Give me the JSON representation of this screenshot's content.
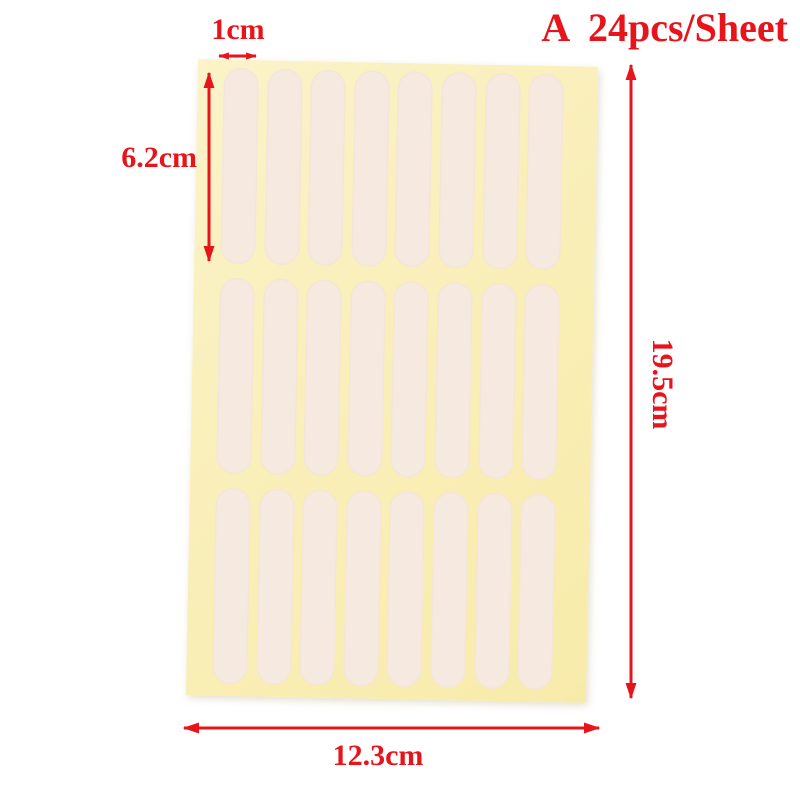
{
  "accent_color": "#e8141b",
  "title": {
    "text": "A  24pcs/Sheet"
  },
  "sheet": {
    "rows": 3,
    "cols": 8,
    "sheet_color": "#f9eeb6",
    "sheet_color_light": "#fbf3c9",
    "sticker_color": "#f6e9e0"
  },
  "dimensions": {
    "sticker_width": "1cm",
    "sticker_height": "6.2cm",
    "sheet_height": "19.5cm",
    "sheet_width": "12.3cm"
  }
}
